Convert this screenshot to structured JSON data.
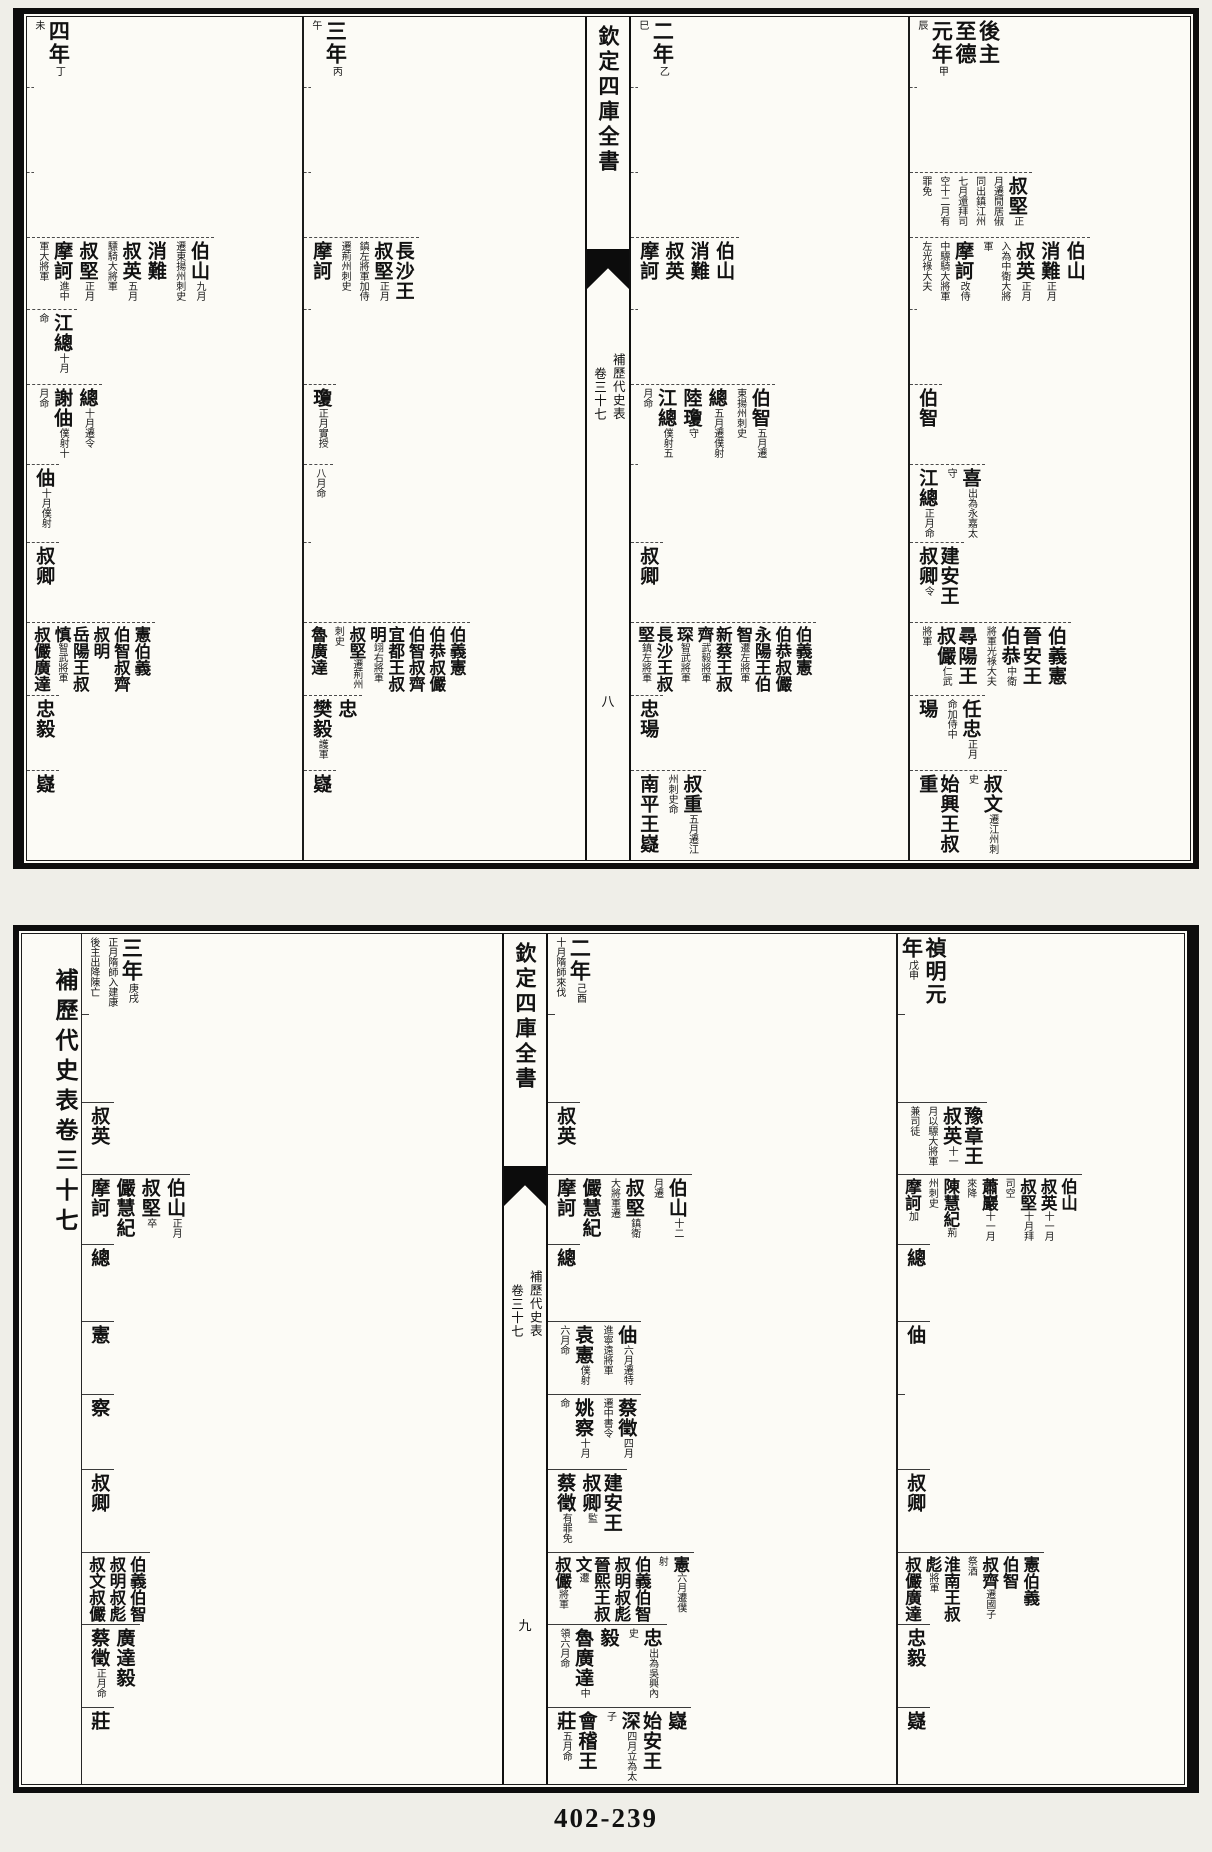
{
  "page_footer": "402-239",
  "blocks": [
    {
      "spine": {
        "title": "欽定四庫全書",
        "book": "補歷代史表",
        "volume": "卷三十七",
        "page": "八"
      },
      "rows_h": [
        70,
        85,
        65,
        72,
        75,
        80,
        78,
        80,
        73,
        75,
        90
      ],
      "left_cols": [
        {
          "label": "四年",
          "note": "丁未",
          "w": 275,
          "rows": {
            "3": [
              {
                "n": "伯山",
                "t": "九月遷東揚州刺史"
              },
              {
                "n": "消難"
              },
              {
                "n": "叔英",
                "t": "五月驃騎大將軍"
              },
              {
                "n": "叔堅",
                "t": "正月"
              },
              {
                "n": "摩訶",
                "t": "進中軍大將軍"
              }
            ],
            "4": [
              {
                "n": "江總",
                "t": "十月命"
              }
            ],
            "5": [
              {
                "n": "總",
                "t": "十月遷令"
              },
              {
                "n": "謝伷",
                "t": "僕射十月命"
              }
            ],
            "6": [
              {
                "n": "伷",
                "t": "十月僕射"
              }
            ],
            "7": [
              {
                "n": "叔卿"
              }
            ],
            "8": [
              {
                "n": "憲"
              },
              {
                "n": "伯義"
              },
              {
                "n": "伯智"
              },
              {
                "n": "叔齊"
              },
              {
                "n": "叔明"
              },
              {
                "n": "岳陽王叔慎",
                "t": "智武將軍"
              },
              {
                "n": "叔儼"
              },
              {
                "n": "廣達"
              }
            ],
            "9": [
              {
                "n": "忠"
              },
              {
                "n": "毅"
              }
            ],
            "10": [
              {
                "n": "嶷"
              }
            ]
          }
        },
        {
          "label": "三年",
          "note": "丙午",
          "w": 283,
          "rows": {
            "3": [
              {
                "n": "長沙王叔堅",
                "t": "正月鎮左將軍加侍遷荊州刺史"
              },
              {
                "n": "摩訶"
              }
            ],
            "5": [
              {
                "n": "瓊",
                "t": "正月實授"
              }
            ],
            "6": [
              {
                "n": "",
                "t": "八月命"
              }
            ],
            "8": [
              {
                "n": "伯義"
              },
              {
                "n": "憲"
              },
              {
                "n": "伯恭"
              },
              {
                "n": "叔儼"
              },
              {
                "n": "伯智"
              },
              {
                "n": "叔齊"
              },
              {
                "n": "宜都王叔明",
                "t": "翊右將軍"
              },
              {
                "n": "叔堅",
                "t": "遷荊州刺史"
              },
              {
                "n": "魯廣達"
              }
            ],
            "9": [
              {
                "n": "忠"
              },
              {
                "n": "樊毅",
                "t": "護軍"
              }
            ],
            "10": [
              {
                "n": "嶷"
              }
            ]
          }
        }
      ],
      "right_cols": [
        {
          "label": "二年",
          "note": "乙巳",
          "w": 277,
          "rows": {
            "3": [
              {
                "n": "伯山"
              },
              {
                "n": "消難"
              },
              {
                "n": "叔英"
              },
              {
                "n": "摩訶"
              }
            ],
            "5": [
              {
                "n": "伯智",
                "t": "五月遷東揚州刺史"
              },
              {
                "n": "總",
                "t": "五月遷僕射"
              },
              {
                "n": "陸瓊",
                "t": "守"
              },
              {
                "n": "江總",
                "t": "僕射五月命"
              }
            ],
            "7": [
              {
                "n": "叔卿"
              }
            ],
            "8": [
              {
                "n": "伯義"
              },
              {
                "n": "憲"
              },
              {
                "n": "伯恭"
              },
              {
                "n": "叔儼"
              },
              {
                "n": "永陽王伯智",
                "t": "遷左將軍"
              },
              {
                "n": "新蔡王叔齊",
                "t": "武毅將軍"
              },
              {
                "n": "琛",
                "t": "智武將軍"
              },
              {
                "n": "長沙王叔堅",
                "t": "鎮左將軍"
              }
            ],
            "9": [
              {
                "n": "忠"
              },
              {
                "n": "瑒"
              }
            ],
            "10": [
              {
                "n": "叔重",
                "t": "五月遷江州刺史命"
              },
              {
                "n": "南平王嶷"
              }
            ]
          }
        },
        {
          "label": "後主至德元年",
          "note": "甲辰",
          "w": 285,
          "rows": {
            "2": [
              {
                "n": "叔堅",
                "t": "正月遷閒居俶同出鎮江州七月還拜司空十二月有罪免"
              }
            ],
            "3": [
              {
                "n": "伯山"
              },
              {
                "n": "消難",
                "t": "正月"
              },
              {
                "n": "叔英",
                "t": "正月入為中衛大將軍"
              },
              {
                "n": "摩訶",
                "t": "改侍中驃騎大將軍左光祿大夫"
              }
            ],
            "5": [
              {
                "n": "伯智"
              }
            ],
            "6": [
              {
                "n": "喜",
                "t": "出為永嘉太守"
              },
              {
                "n": "江總",
                "t": "正月命"
              }
            ],
            "7": [
              {
                "n": "建安王叔卿",
                "t": "令"
              }
            ],
            "8": [
              {
                "n": "伯義"
              },
              {
                "n": "憲"
              },
              {
                "n": "晉安王伯恭",
                "t": "中衛將軍光祿大夫"
              },
              {
                "n": "尋陽王叔儼",
                "t": "仁武將軍"
              }
            ],
            "9": [
              {
                "n": "任忠",
                "t": "正月命加侍中"
              },
              {
                "n": "瑒"
              }
            ],
            "10": [
              {
                "n": "叔文",
                "t": "遷江州刺史"
              },
              {
                "n": "始興王叔重"
              }
            ]
          }
        }
      ]
    },
    {
      "edge_title": "補歷代史表卷三十七",
      "spine": {
        "title": "欽定四庫全書",
        "book": "補歷代史表",
        "volume": "卷三十七",
        "page": "九"
      },
      "rows_h": [
        80,
        88,
        72,
        70,
        77,
        73,
        75,
        83,
        72,
        83,
        77
      ],
      "left_cols": [
        {
          "label": "三年",
          "note": "庚戌正月隋師入建康後主出降陳亡",
          "w": 420,
          "rows": {
            "2": [
              {
                "n": "叔英"
              }
            ],
            "3": [
              {
                "n": "伯山",
                "t": "正月"
              },
              {
                "n": "叔堅",
                "t": "卒"
              },
              {
                "n": "儼"
              },
              {
                "n": "慧紀"
              },
              {
                "n": "摩訶"
              }
            ],
            "4": [
              {
                "n": "總"
              }
            ],
            "5": [
              {
                "n": "憲"
              }
            ],
            "6": [
              {
                "n": "察"
              }
            ],
            "7": [
              {
                "n": "叔卿"
              }
            ],
            "8": [
              {
                "n": "伯義"
              },
              {
                "n": "伯智"
              },
              {
                "n": "叔明"
              },
              {
                "n": "叔彪"
              },
              {
                "n": "叔文"
              },
              {
                "n": "叔儼"
              }
            ],
            "9": [
              {
                "n": "廣達"
              },
              {
                "n": "毅"
              },
              {
                "n": "蔡徵",
                "t": "正月命"
              }
            ],
            "10": [
              {
                "n": "莊"
              }
            ]
          }
        }
      ],
      "right_cols": [
        {
          "label": "二年",
          "note": "己酉十月隋師來伐",
          "w": 348,
          "rows": {
            "2": [
              {
                "n": "叔英"
              }
            ],
            "3": [
              {
                "n": "伯山",
                "t": "十二月遷"
              },
              {
                "n": "叔堅",
                "t": "鎮衛大將軍遷"
              },
              {
                "n": "儼"
              },
              {
                "n": "慧紀"
              },
              {
                "n": "摩訶"
              }
            ],
            "4": [
              {
                "n": "總"
              }
            ],
            "5": [
              {
                "n": "伷",
                "t": "六月遷特進寧遠將軍"
              },
              {
                "n": "袁憲",
                "t": "僕射六月命"
              }
            ],
            "6": [
              {
                "n": "蔡徵",
                "t": "四月遷中書令"
              },
              {
                "n": "姚察",
                "t": "十月命"
              }
            ],
            "7": [
              {
                "n": "建安王叔卿",
                "t": "監"
              },
              {
                "n": "蔡徵",
                "t": "有罪免"
              }
            ],
            "8": [
              {
                "n": "憲",
                "t": "六月遷僕射"
              },
              {
                "n": "伯義"
              },
              {
                "n": "伯智"
              },
              {
                "n": "叔明"
              },
              {
                "n": "叔彪"
              },
              {
                "n": "晉熙王叔文",
                "t": "遷"
              },
              {
                "n": "叔儼",
                "t": "將軍"
              }
            ],
            "9": [
              {
                "n": "忠",
                "t": "出為吳興內史"
              },
              {
                "n": "毅"
              },
              {
                "n": "魯廣達",
                "t": "中領六月命"
              }
            ],
            "10": [
              {
                "n": "嶷"
              },
              {
                "n": "始安王深",
                "t": "四月立為太子"
              },
              {
                "n": "會稽王莊",
                "t": "五月命"
              }
            ]
          }
        },
        {
          "label": "禎明元年",
          "note": "戊申",
          "w": 292,
          "rows": {
            "2": [
              {
                "n": "豫章王叔英",
                "t": "十一月以驃大將軍兼司徒"
              }
            ],
            "3": [
              {
                "n": "伯山"
              },
              {
                "n": "叔英",
                "t": "十一月"
              },
              {
                "n": "叔堅",
                "t": "十月拜司空"
              },
              {
                "n": "蕭巖",
                "t": "十一月來降"
              },
              {
                "n": "陳慧紀",
                "t": "荊州刺史"
              },
              {
                "n": "摩訶",
                "t": "加"
              }
            ],
            "4": [
              {
                "n": "總"
              }
            ],
            "5": [
              {
                "n": "伷"
              }
            ],
            "7": [
              {
                "n": "叔卿"
              }
            ],
            "8": [
              {
                "n": "憲"
              },
              {
                "n": "伯義"
              },
              {
                "n": "伯智"
              },
              {
                "n": "叔齊",
                "t": "遷國子祭酒"
              },
              {
                "n": "淮南王叔彪",
                "t": "將軍"
              },
              {
                "n": "叔儼"
              },
              {
                "n": "廣達"
              }
            ],
            "9": [
              {
                "n": "忠"
              },
              {
                "n": "毅"
              }
            ],
            "10": [
              {
                "n": "嶷"
              }
            ]
          }
        }
      ]
    }
  ]
}
